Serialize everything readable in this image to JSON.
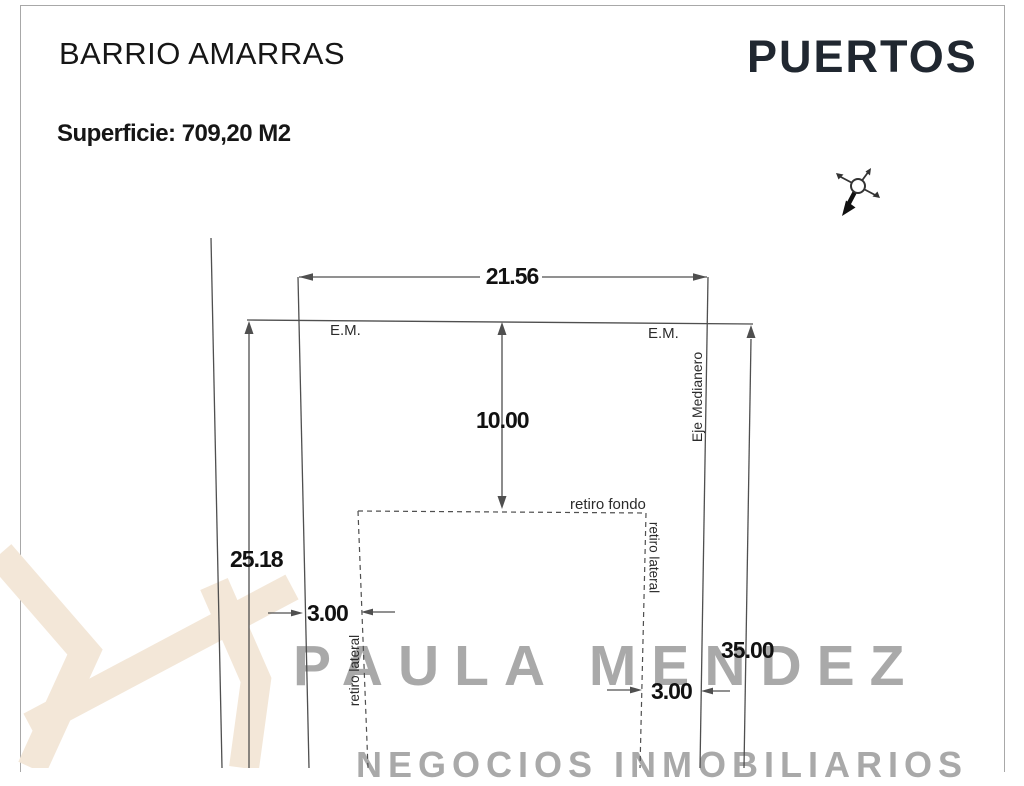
{
  "header": {
    "title": "BARRIO AMARRAS",
    "surface": "Superficie: 709,20 M2",
    "brand": "PUERTOS"
  },
  "plan": {
    "dim_front_width": "21.56",
    "dim_left_side": "25.18",
    "dim_right_side": "35.00",
    "dim_rear_setback_depth": "10.00",
    "dim_lateral_setback_left": "3.00",
    "dim_lateral_setback_right": "3.00",
    "label_em_left": "E.M.",
    "label_em_right": "E.M.",
    "label_eje_medianero": "Eje Medianero",
    "label_retiro_fondo": "retiro fondo",
    "label_retiro_lateral_left": "retiro lateral",
    "label_retiro_lateral_right": "retiro lateral"
  },
  "watermark": {
    "name": "PAULA MENDEZ",
    "tagline": "NEGOCIOS INMOBILIARIOS"
  },
  "icons": {
    "compass": "north-arrow-compass"
  },
  "colors": {
    "line": "#4f4f4f",
    "text": "#161616",
    "brand": "#202730",
    "frame": "#a8a8a8",
    "watermark_text": "#a9a9a9",
    "watermark_logo": "#f3e7d8"
  }
}
